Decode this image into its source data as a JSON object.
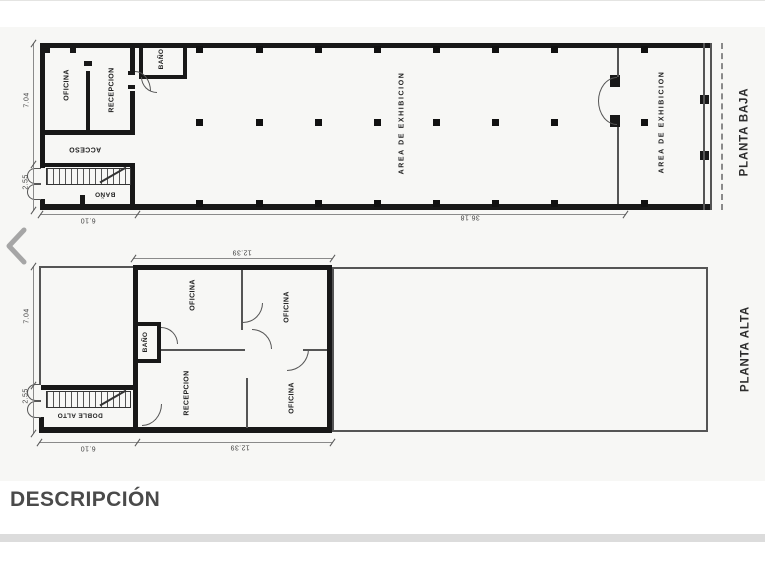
{
  "viewer": {
    "description_heading": "DESCRIPCIÓN"
  },
  "planta_baja": {
    "title": "PLANTA BAJA",
    "labels": {
      "oficina": "OFICINA",
      "recepcion": "RECEPCION",
      "bano_top": "BAÑO",
      "acceso": "ACCESO",
      "bano_lower": "BAÑO",
      "area_exhibicion_1": "AREA DE EXHIBICION",
      "area_exhibicion_2": "AREA DE EXHIBICION"
    },
    "dimensions": {
      "height_upper": "7.04",
      "height_lower": "2.55",
      "width_left": "6.10",
      "width_total": "36.18"
    }
  },
  "planta_alta": {
    "title": "PLANTA ALTA",
    "labels": {
      "oficina_1": "OFICINA",
      "oficina_2": "OFICINA",
      "oficina_3": "OFICINA",
      "recepcion": "RECEPCION",
      "bano": "BAÑO",
      "doble_alto": "DOBLE ALTO"
    },
    "dimensions": {
      "height_upper": "7.04",
      "height_lower": "2.55",
      "width_left": "6.10",
      "width_block_top": "12.39",
      "width_block_bottom": "12.39"
    }
  }
}
